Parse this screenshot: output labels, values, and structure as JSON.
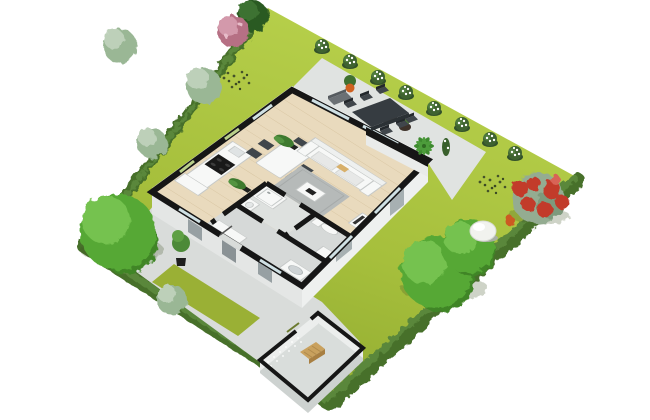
{
  "scene": {
    "type": "3d-floor-plan-garden-render",
    "view": "isometric-top-down",
    "background": "#ffffff"
  },
  "palette": {
    "background": "#ffffff",
    "grass_light": "#b8d14c",
    "grass_mid": "#a6bf3c",
    "grass_dark": "#8da72e",
    "grass_strip": "#9ab035",
    "hedge_dark": "#476f2a",
    "hedge_mid": "#5a873a",
    "paving": "#d9dcda",
    "terrace": "#e0e3e1",
    "wall_black": "#161616",
    "wall_face": "#e4e6e5",
    "wall_face_light": "#eef0ef",
    "glass": "#cfe0e4",
    "glass_green": "#b9cf8a",
    "wood": "#e9dabd",
    "wood_line": "#d8c5a2",
    "room_gray": "#d6d9d8",
    "room_gray2": "#dee1df",
    "white_furniture": "#f7f8f7",
    "furn_stroke": "#c6c9c8",
    "cushion": "#e7e8e7",
    "rug": "#b6bab9",
    "rug_border": "#a6aaa9",
    "dark_chair": "#40464b",
    "dark_table": "#363c41",
    "stove": "#191919",
    "plant": "#3e7a2f",
    "pot_dark": "#20221f",
    "pot_orange": "#cf6120",
    "tree_bright": "#57a836",
    "tree_bright_hi": "#74c24f",
    "tree_bright_sh": "#3f8526",
    "tree_silver": "#9ab795",
    "tree_silver_hi": "#bdd0b9",
    "tree_conifer": "#2c5a21",
    "tree_conifer_hi": "#3e7230",
    "tree_pink": "#b66f84",
    "tree_pink_hi": "#d399ab",
    "bush_green": "#3f6330",
    "flower_white": "#ffffff",
    "redbush_foliage": "#94ac91",
    "redbush_red": "#c23a2c",
    "redbush_orange": "#cc5a24",
    "boulder": "#f1f2ee",
    "boulder_shadow": "#a8afa2",
    "bench_wood": "#c9a15e",
    "bench_wood_dark": "#a87f42",
    "bench_gray": "#6b7074",
    "shed_floor": "#d9dddb",
    "shed_wall": "#eceeed",
    "shed_face": "#cdd2d0",
    "lavender": "#44522a",
    "bowl_brown": "#5c483a"
  },
  "house": {
    "rooms": [
      "open-living-room",
      "dining-area",
      "kitchen",
      "hallway",
      "bathroom",
      "wc"
    ],
    "furniture": [
      "sofa",
      "gray-rug",
      "coffee-table",
      "dining-table",
      "dining-chairs",
      "kitchen-counter",
      "stove",
      "fridge",
      "tv-cabinet",
      "shower",
      "bathroom-sink",
      "toilet",
      "washer",
      "wardrobe",
      "potted-plants"
    ]
  },
  "garden": {
    "structures": [
      "terrace",
      "paved-path",
      "garden-shed",
      "garden-wall",
      "perimeter-hedge"
    ],
    "terrace_items": [
      "outdoor-dining-table",
      "outdoor-chairs",
      "garden-bench",
      "planter-bowls",
      "palm-plant",
      "orange-pot-plant"
    ],
    "plants": [
      "large-green-tree",
      "two-bright-green-trees",
      "silver-green-trees",
      "pink-flowering-tree",
      "dark-conifer",
      "red-flower-bush",
      "white-flower-bushes-row",
      "lavender-patches",
      "front-door-plant",
      "shed-bench",
      "white-boulder"
    ]
  }
}
